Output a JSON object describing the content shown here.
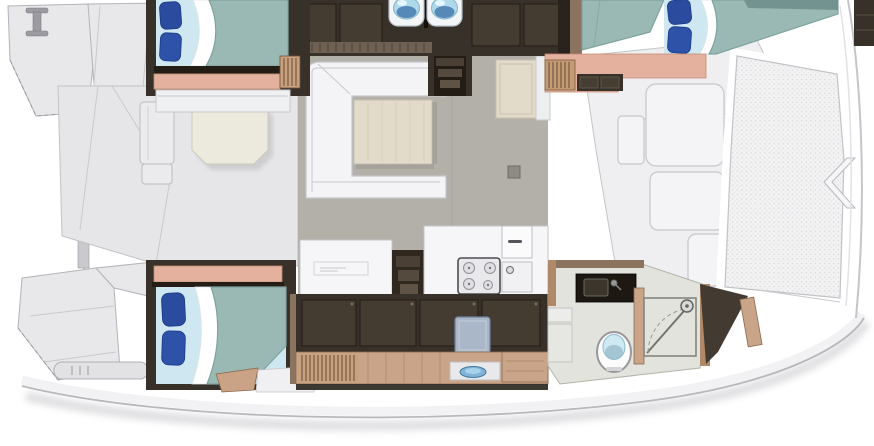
{
  "image": {
    "kind": "catamaran-interior-deck-plan",
    "orientation": "bow-right"
  },
  "palette": {
    "deck_light": "#e8e8ea",
    "hull_white": "#f2f2f4",
    "outline": "#b3b3b8",
    "floor_gray": "#b3b0a9",
    "wood_dark": "#38312a",
    "wood_panel": "#443b31",
    "wood_shadow": "#241d16",
    "wood_tan": "#c9a488",
    "wood_edge": "#8a6a4e",
    "wood_trim": "#8a7460",
    "salmon": "#e3b19d",
    "bed_teal": "#9bb9b4",
    "bed_teal_edge": "#7da39e",
    "sheet_blue": "#cfe7f1",
    "pillow_blue": "#2b4b9e",
    "pillow_blue2": "#2e52a8",
    "sofa_white": "#f4f4f6",
    "counter_white": "#f6f6f8",
    "table_beige": "#e2dbc9",
    "cockpit_table": "#eceadd",
    "stool_blue": "#a9b7c8",
    "bath_floor": "#e3e3de",
    "fixture_blue": "#aed9ea",
    "fixture_blue_deep": "#3f74ab",
    "mesh_base": "#f3f3f4",
    "mesh_dot": "#dcdcdf"
  },
  "parts": [
    "port-stern-platform",
    "mooring-cleat",
    "gangway-rail",
    "cockpit",
    "cockpit-table",
    "cockpit-bench",
    "port-aft-cabin-bed",
    "blue-pillows",
    "louver-locker",
    "twin-wash-basins",
    "saloon",
    "saloon-sofa",
    "saloon-table",
    "fridge-cabinet",
    "companionway-steps",
    "galley-counter",
    "cooktop",
    "cabin-doors",
    "forward-berth",
    "forward-steps",
    "foredeck",
    "foredeck-lockers",
    "trampoline",
    "bow-bridle",
    "starboard-aft-cabin-bed",
    "hull-cabinets",
    "vanity-stool",
    "galley-sink-bowl",
    "bathroom",
    "vanity-basin",
    "toilet",
    "shower-enclosure",
    "shower-drain",
    "starboard-stern-platform",
    "boarding-step"
  ]
}
